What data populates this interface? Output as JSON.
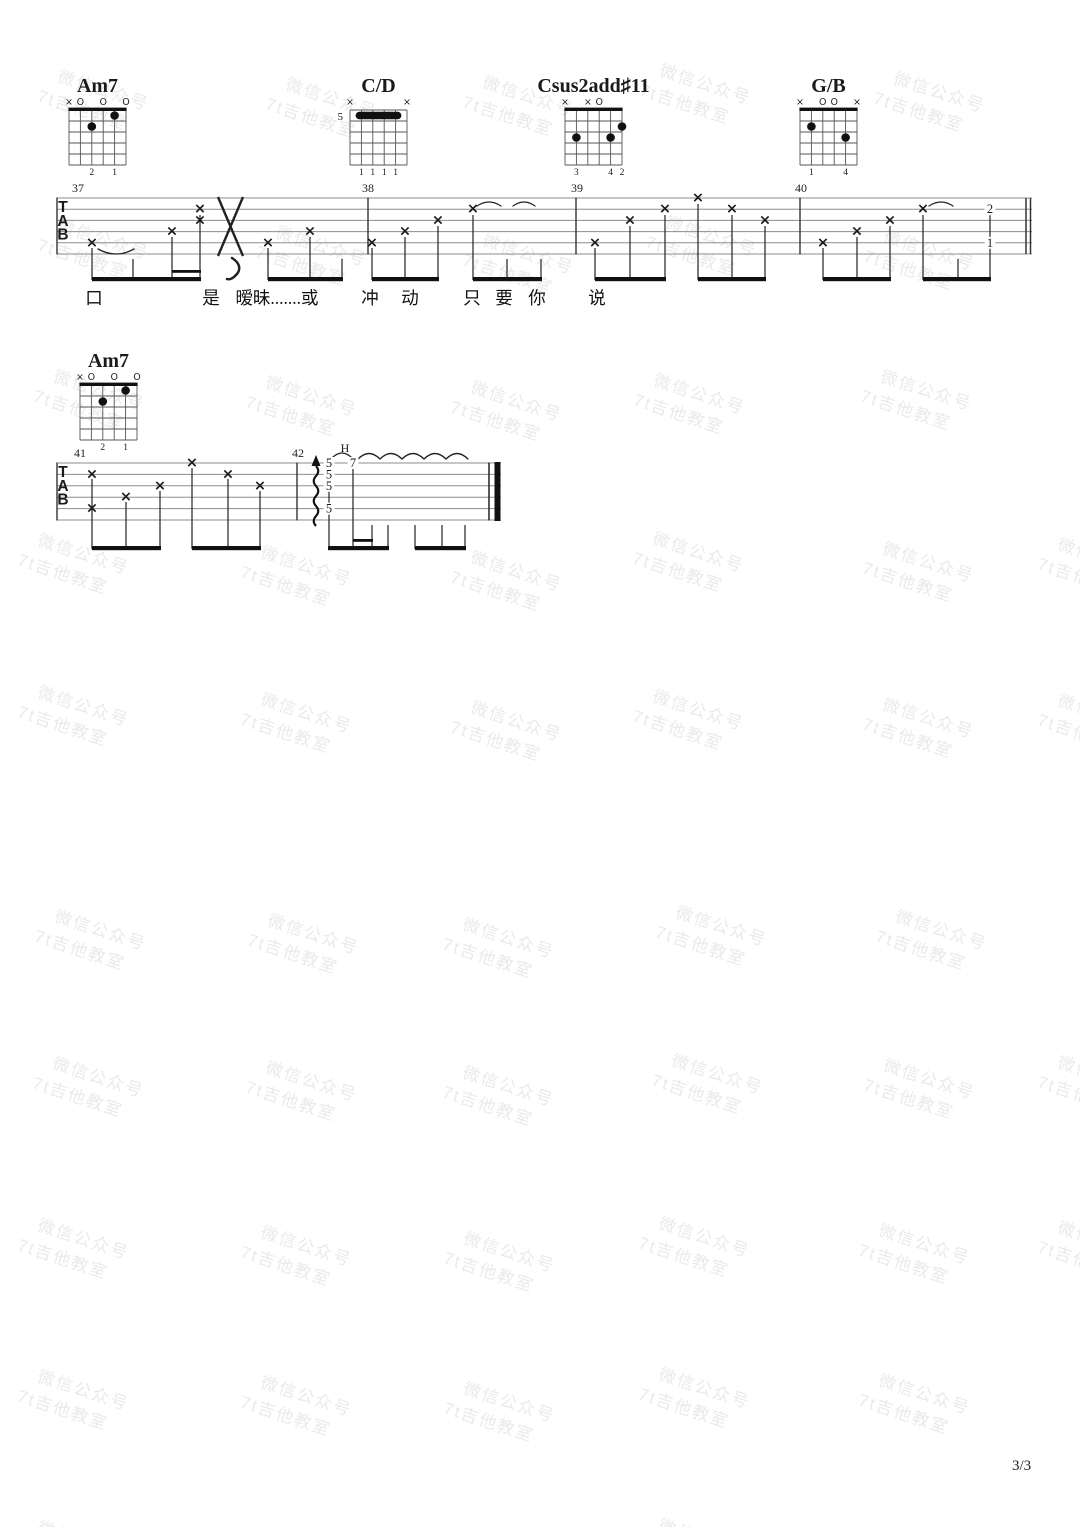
{
  "page": {
    "number_label": "3/3"
  },
  "tab_clef": [
    "T",
    "A",
    "B"
  ],
  "watermark": {
    "line1": "微信公众号",
    "line2": "7t吉他教室",
    "color": "#eaeaea",
    "rotation_deg": 18,
    "positions": [
      [
        62,
        64
      ],
      [
        290,
        72
      ],
      [
        487,
        70
      ],
      [
        664,
        58
      ],
      [
        898,
        66
      ],
      [
        62,
        213
      ],
      [
        280,
        220
      ],
      [
        487,
        228
      ],
      [
        670,
        210
      ],
      [
        888,
        224
      ],
      [
        58,
        364
      ],
      [
        270,
        370
      ],
      [
        475,
        375
      ],
      [
        658,
        368
      ],
      [
        885,
        364
      ],
      [
        42,
        528
      ],
      [
        265,
        540
      ],
      [
        475,
        545
      ],
      [
        657,
        526
      ],
      [
        887,
        536
      ],
      [
        1062,
        532
      ],
      [
        42,
        680
      ],
      [
        265,
        687
      ],
      [
        475,
        695
      ],
      [
        657,
        684
      ],
      [
        887,
        692
      ],
      [
        1062,
        688
      ],
      [
        59,
        904
      ],
      [
        272,
        908
      ],
      [
        467,
        912
      ],
      [
        680,
        900
      ],
      [
        900,
        904
      ],
      [
        57,
        1051
      ],
      [
        270,
        1055
      ],
      [
        467,
        1060
      ],
      [
        676,
        1048
      ],
      [
        888,
        1053
      ],
      [
        1062,
        1050
      ],
      [
        42,
        1213
      ],
      [
        265,
        1220
      ],
      [
        468,
        1226
      ],
      [
        663,
        1211
      ],
      [
        883,
        1218
      ],
      [
        1062,
        1215
      ],
      [
        42,
        1364
      ],
      [
        265,
        1370
      ],
      [
        468,
        1376
      ],
      [
        663,
        1362
      ],
      [
        883,
        1368
      ],
      [
        42,
        1515
      ],
      [
        663,
        1513
      ]
    ]
  },
  "chord_diagrams": [
    {
      "name": "Am7",
      "grid_x": 69,
      "grid_y": 110,
      "nut": true,
      "pos_label": "",
      "markers": [
        {
          "s": 6,
          "t": "×"
        },
        {
          "s": 5,
          "t": "O"
        },
        {
          "s": 3,
          "t": "O"
        },
        {
          "s": 1,
          "t": "O"
        }
      ],
      "dots": [
        {
          "s": 4,
          "f": 2
        },
        {
          "s": 2,
          "f": 1
        }
      ],
      "barre": null,
      "fingers": [
        {
          "s": 4,
          "t": "2"
        },
        {
          "s": 2,
          "t": "1"
        }
      ]
    },
    {
      "name": "C/D",
      "grid_x": 350,
      "grid_y": 110,
      "nut": false,
      "pos_label": "5",
      "markers": [
        {
          "s": 6,
          "t": "×"
        },
        {
          "s": 1,
          "t": "×"
        }
      ],
      "dots": [],
      "barre": {
        "f": 1,
        "s1": 5,
        "s2": 2
      },
      "fingers": [
        {
          "s": 5,
          "t": "1"
        },
        {
          "s": 4,
          "t": "1"
        },
        {
          "s": 3,
          "t": "1"
        },
        {
          "s": 2,
          "t": "1"
        }
      ]
    },
    {
      "name": "Csus2add♯11",
      "grid_x": 565,
      "grid_y": 110,
      "nut": true,
      "pos_label": "",
      "markers": [
        {
          "s": 6,
          "t": "×"
        },
        {
          "s": 4,
          "t": "×"
        },
        {
          "s": 3,
          "t": "O"
        }
      ],
      "dots": [
        {
          "s": 5,
          "f": 3
        },
        {
          "s": 2,
          "f": 3
        },
        {
          "s": 1,
          "f": 2
        }
      ],
      "barre": null,
      "fingers": [
        {
          "s": 5,
          "t": "3"
        },
        {
          "s": 2,
          "t": "4"
        },
        {
          "s": 1,
          "t": "2"
        }
      ]
    },
    {
      "name": "G/B",
      "grid_x": 800,
      "grid_y": 110,
      "nut": true,
      "pos_label": "",
      "markers": [
        {
          "s": 6,
          "t": "×"
        },
        {
          "s": 4,
          "t": "O"
        },
        {
          "s": 3,
          "t": "O"
        },
        {
          "s": 1,
          "t": "×"
        }
      ],
      "dots": [
        {
          "s": 5,
          "f": 2
        },
        {
          "s": 2,
          "f": 3
        }
      ],
      "barre": null,
      "fingers": [
        {
          "s": 5,
          "t": "1"
        },
        {
          "s": 2,
          "t": "4"
        }
      ]
    },
    {
      "name": "Am7",
      "grid_x": 80,
      "grid_y": 385,
      "nut": true,
      "pos_label": "",
      "markers": [
        {
          "s": 6,
          "t": "×"
        },
        {
          "s": 5,
          "t": "O"
        },
        {
          "s": 3,
          "t": "O"
        },
        {
          "s": 1,
          "t": "O"
        }
      ],
      "dots": [
        {
          "s": 4,
          "f": 2
        },
        {
          "s": 2,
          "f": 1
        }
      ],
      "barre": null,
      "fingers": [
        {
          "s": 4,
          "t": "2"
        },
        {
          "s": 2,
          "t": "1"
        }
      ]
    }
  ],
  "systems": [
    {
      "top": 198,
      "gap": 11.2,
      "left": 57,
      "right": 1032,
      "measure_labels": [
        {
          "text": "37",
          "x": 78
        },
        {
          "text": "38",
          "x": 368
        },
        {
          "text": "39",
          "x": 577
        },
        {
          "text": "40",
          "x": 801
        }
      ],
      "barlines": [
        57,
        368,
        576,
        800
      ],
      "end": {
        "type": "double-thin",
        "x": 1026
      },
      "notes": [
        {
          "x": 92,
          "s": 5,
          "t": "x"
        },
        {
          "x": 172,
          "s": 4,
          "t": "x"
        },
        {
          "x": 200,
          "s": 2,
          "t": "x"
        },
        {
          "x": 200,
          "s": 3,
          "t": "x"
        },
        {
          "x": 268,
          "s": 5,
          "t": "x"
        },
        {
          "x": 310,
          "s": 4,
          "t": "x"
        },
        {
          "x": 372,
          "s": 5,
          "t": "x"
        },
        {
          "x": 405,
          "s": 4,
          "t": "x"
        },
        {
          "x": 438,
          "s": 3,
          "t": "x"
        },
        {
          "x": 473,
          "s": 2,
          "t": "x"
        },
        {
          "x": 595,
          "s": 5,
          "t": "x"
        },
        {
          "x": 630,
          "s": 3,
          "t": "x"
        },
        {
          "x": 665,
          "s": 2,
          "t": "x"
        },
        {
          "x": 698,
          "s": 1,
          "t": "x"
        },
        {
          "x": 732,
          "s": 2,
          "t": "x"
        },
        {
          "x": 765,
          "s": 3,
          "t": "x"
        },
        {
          "x": 823,
          "s": 5,
          "t": "x"
        },
        {
          "x": 857,
          "s": 4,
          "t": "x"
        },
        {
          "x": 890,
          "s": 3,
          "t": "x"
        },
        {
          "x": 923,
          "s": 2,
          "t": "x"
        },
        {
          "x": 990,
          "s": 2,
          "t": "2"
        },
        {
          "x": 990,
          "s": 5,
          "t": "1"
        }
      ],
      "stems": [
        {
          "x": 92,
          "top": 248
        },
        {
          "x": 133,
          "top": 259
        },
        {
          "x": 172,
          "top": 237
        },
        {
          "x": 200,
          "top": 215
        },
        {
          "x": 268,
          "top": 248
        },
        {
          "x": 310,
          "top": 237
        },
        {
          "x": 342,
          "top": 259
        },
        {
          "x": 372,
          "top": 248
        },
        {
          "x": 405,
          "top": 237
        },
        {
          "x": 438,
          "top": 226
        },
        {
          "x": 473,
          "top": 215
        },
        {
          "x": 507,
          "top": 259
        },
        {
          "x": 541,
          "top": 259
        },
        {
          "x": 595,
          "top": 248
        },
        {
          "x": 630,
          "top": 226
        },
        {
          "x": 665,
          "top": 215
        },
        {
          "x": 698,
          "top": 204
        },
        {
          "x": 732,
          "top": 215
        },
        {
          "x": 765,
          "top": 226
        },
        {
          "x": 823,
          "top": 248
        },
        {
          "x": 857,
          "top": 237
        },
        {
          "x": 890,
          "top": 226
        },
        {
          "x": 923,
          "top": 215
        },
        {
          "x": 958,
          "top": 259
        },
        {
          "x": 990,
          "top": 214
        }
      ],
      "beams": [
        {
          "x1": 92,
          "x2": 201
        },
        {
          "x1": 268,
          "x2": 343
        },
        {
          "x1": 372,
          "x2": 439
        },
        {
          "x1": 473,
          "x2": 542
        },
        {
          "x1": 595,
          "x2": 666
        },
        {
          "x1": 698,
          "x2": 766
        },
        {
          "x1": 823,
          "x2": 891
        },
        {
          "x1": 923,
          "x2": 991
        }
      ],
      "beam_y": 277,
      "beams16": [
        {
          "x1": 172,
          "x2": 201,
          "y": 270
        }
      ],
      "arcs": [
        {
          "d": "M98,249 Q116,259 134,249"
        },
        {
          "d": "M477,206 Q489,198 501,206"
        },
        {
          "d": "M513,206 Q524,198 535,206"
        },
        {
          "d": "M929,206 Q941,198 953,206"
        }
      ],
      "bigx": {
        "x1": 218,
        "x2": 243,
        "y1": 197,
        "y2": 256
      },
      "comma": {
        "d": "M232,258 C240,263 242,270 235,276 C233,278 230,280 227,279"
      },
      "lyrics_y": 304,
      "lyrics": [
        {
          "text": "口",
          "x": 94
        },
        {
          "text": "是",
          "x": 211
        },
        {
          "text": "暧昧.......或",
          "x": 277
        },
        {
          "text": "冲",
          "x": 370
        },
        {
          "text": "动",
          "x": 410
        },
        {
          "text": "只",
          "x": 472
        },
        {
          "text": "要",
          "x": 504
        },
        {
          "text": "你",
          "x": 537
        },
        {
          "text": "说",
          "x": 597
        }
      ]
    },
    {
      "top": 463,
      "gap": 11.4,
      "left": 57,
      "right": 501,
      "measure_labels": [
        {
          "text": "41",
          "x": 80
        },
        {
          "text": "42",
          "x": 298
        }
      ],
      "barlines": [
        57,
        297
      ],
      "end": {
        "type": "final",
        "x": 489
      },
      "notes": [
        {
          "x": 92,
          "s": 2,
          "t": "x"
        },
        {
          "x": 92,
          "s": 5,
          "t": "x"
        },
        {
          "x": 126,
          "s": 4,
          "t": "x"
        },
        {
          "x": 160,
          "s": 3,
          "t": "x"
        },
        {
          "x": 192,
          "s": 1,
          "t": "x"
        },
        {
          "x": 228,
          "s": 2,
          "t": "x"
        },
        {
          "x": 260,
          "s": 3,
          "t": "x"
        },
        {
          "x": 329,
          "s": 1,
          "t": "5"
        },
        {
          "x": 329,
          "s": 2,
          "t": "5"
        },
        {
          "x": 329,
          "s": 3,
          "t": "5"
        },
        {
          "x": 329,
          "s": 5,
          "t": "5"
        },
        {
          "x": 353,
          "s": 1,
          "t": "7"
        }
      ],
      "stems": [
        {
          "x": 92,
          "top": 479
        },
        {
          "x": 126,
          "top": 502
        },
        {
          "x": 160,
          "top": 491
        },
        {
          "x": 192,
          "top": 468
        },
        {
          "x": 228,
          "top": 479
        },
        {
          "x": 260,
          "top": 491
        },
        {
          "x": 329,
          "top": 467
        },
        {
          "x": 353,
          "top": 468
        },
        {
          "x": 372,
          "top": 525
        },
        {
          "x": 388,
          "top": 525
        },
        {
          "x": 415,
          "top": 525
        },
        {
          "x": 442,
          "top": 525
        },
        {
          "x": 465,
          "top": 525
        }
      ],
      "beams": [
        {
          "x1": 92,
          "x2": 161
        },
        {
          "x1": 192,
          "x2": 261
        },
        {
          "x1": 328,
          "x2": 389
        },
        {
          "x1": 415,
          "x2": 466
        }
      ],
      "beam_y": 546,
      "beams16": [
        {
          "x1": 353,
          "x2": 373,
          "y": 539
        }
      ],
      "arcs": [
        {
          "d": "M331,459 Q342,447 353,459"
        },
        {
          "d": "M358,459 Q369,448 380,459"
        },
        {
          "d": "M380,459 Q391,448 402,459"
        },
        {
          "d": "M402,459 Q413,448 424,459"
        },
        {
          "d": "M424,459 Q435,448 446,459"
        },
        {
          "d": "M446,459 Q457,448 468,459"
        }
      ],
      "hammer_label": {
        "text": "H",
        "x": 345,
        "y": 452
      },
      "arrow": {
        "x": 316,
        "tip": 455,
        "base": 466,
        "tail": 526
      },
      "lyrics_y": 0,
      "lyrics": []
    }
  ]
}
